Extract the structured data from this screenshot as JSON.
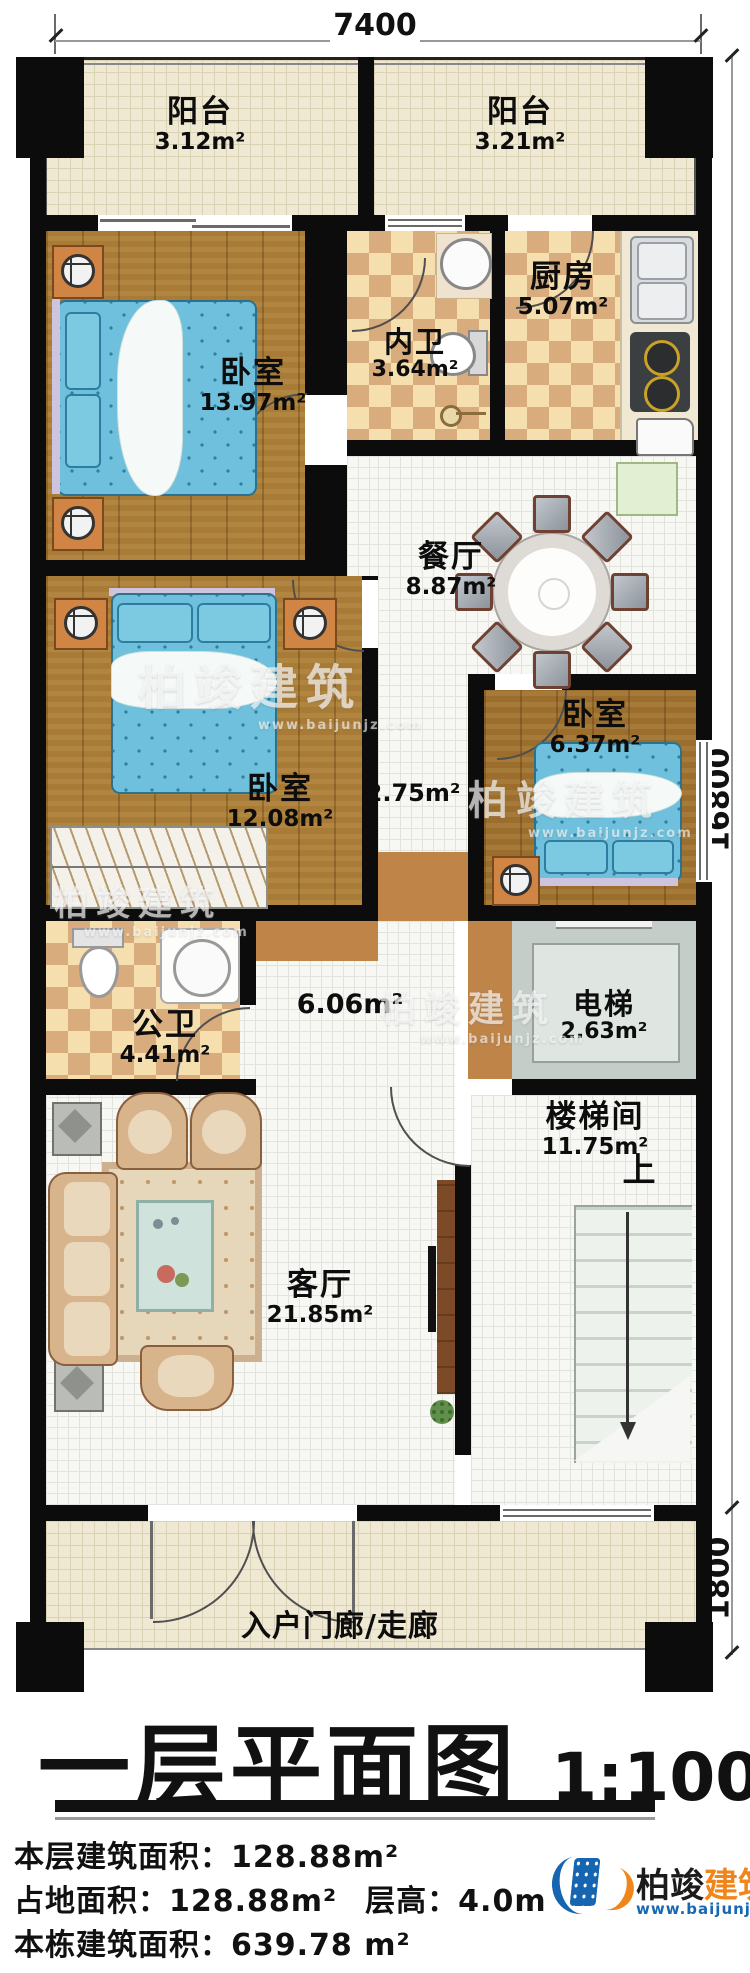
{
  "plan": {
    "dimensions": {
      "top": "7400",
      "right_upper": "16800",
      "right_lower": "1800"
    },
    "rooms": {
      "balcony_left": {
        "name": "阳台",
        "area": "3.12m²"
      },
      "balcony_right": {
        "name": "阳台",
        "area": "3.21m²"
      },
      "bedroom_top": {
        "name": "卧室",
        "area": "13.97m²"
      },
      "inner_bathroom": {
        "name": "内卫",
        "area": "3.64m²"
      },
      "kitchen": {
        "name": "厨房",
        "area": "5.07m²"
      },
      "dining": {
        "name": "餐厅",
        "area": "8.87m²"
      },
      "bedroom_middle": {
        "name": "卧室",
        "area": "12.08m²"
      },
      "corridor": {
        "area": "2.75m²"
      },
      "bedroom_right": {
        "name": "卧室",
        "area": "6.37m²"
      },
      "public_bathroom": {
        "name": "公卫",
        "area": "4.41m²"
      },
      "hallway": {
        "area": "6.06m²"
      },
      "elevator": {
        "name": "电梯",
        "area": "2.63m²"
      },
      "stairwell": {
        "name": "楼梯间",
        "area": "11.75m²",
        "direction": "上"
      },
      "living": {
        "name": "客厅",
        "area": "21.85m²"
      },
      "entry_porch": {
        "name": "入户门廊/走廊"
      }
    }
  },
  "title_block": {
    "title": "一层平面图",
    "scale": "1:100",
    "info": [
      {
        "label": "本层建筑面积：",
        "value": "128.88m²"
      },
      {
        "label": "占地面积：",
        "value": "128.88m²",
        "label2": "层高：",
        "value2": "4.0m"
      },
      {
        "label": "本栋建筑面积：",
        "value": "639.78 m²"
      }
    ]
  },
  "branding": {
    "name_part1": "柏竣",
    "name_part2": "建筑",
    "website": "www.baijunjz.com"
  },
  "watermark": {
    "text": "柏竣建筑",
    "website": "www.baijunjz.com"
  }
}
